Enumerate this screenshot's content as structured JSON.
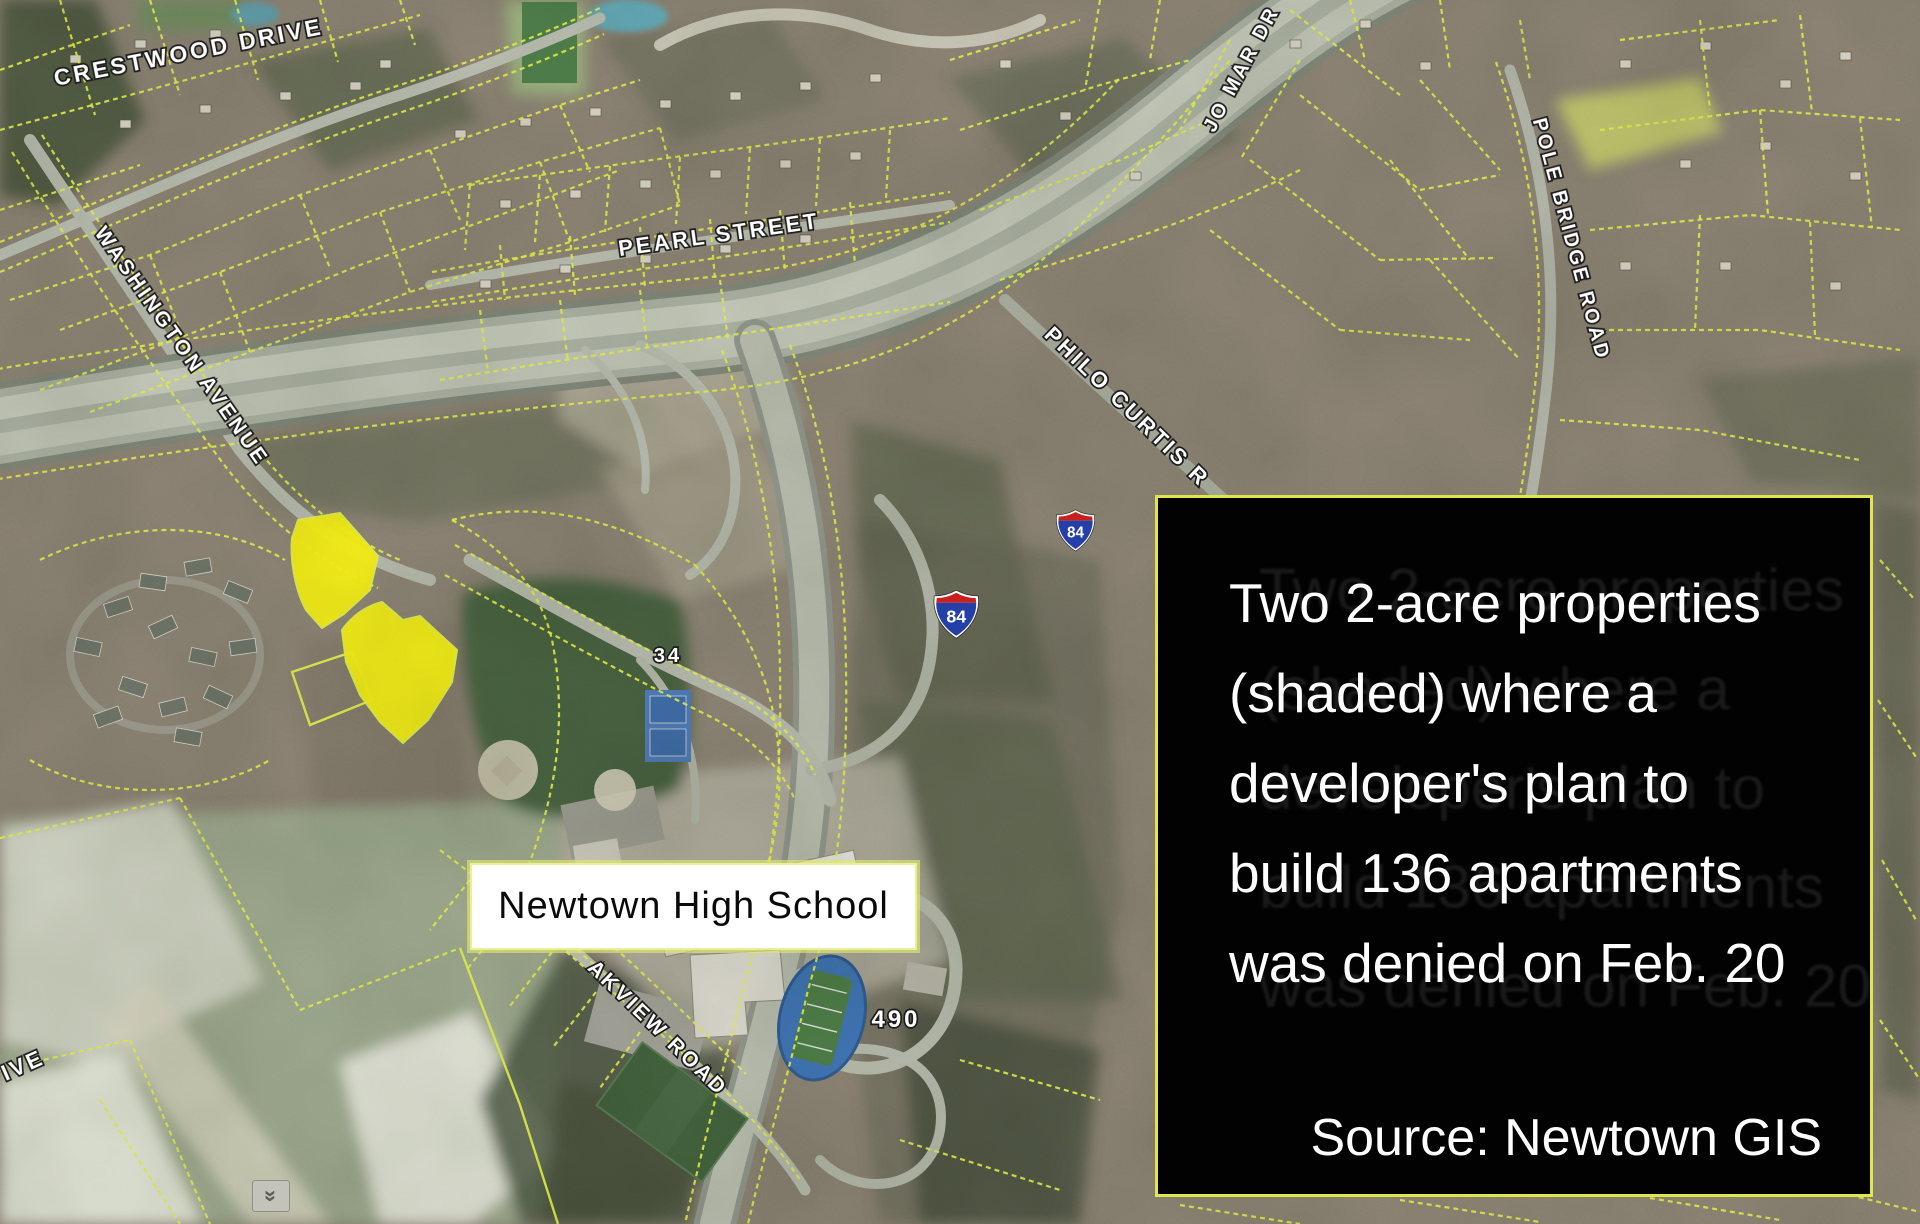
{
  "map": {
    "street_labels": [
      {
        "id": "crestwood",
        "text": "CRESTWOOD DRIVE"
      },
      {
        "id": "washington",
        "text": "WASHINGTON AVENUE"
      },
      {
        "id": "pearl",
        "text": "PEARL STREET"
      },
      {
        "id": "jomar",
        "text": "JO MAR DR"
      },
      {
        "id": "philo",
        "text": "PHILO CURTIS R"
      },
      {
        "id": "polebridge",
        "text": "POLE BRIDGE ROAD"
      },
      {
        "id": "oakview",
        "text": "AKVIEW ROAD"
      },
      {
        "id": "ive",
        "text": "IVE"
      }
    ],
    "route_shields": [
      {
        "number": "84"
      },
      {
        "number": "84"
      }
    ],
    "road_numbers": [
      {
        "text": "34"
      },
      {
        "text": "490"
      }
    ]
  },
  "school_label": {
    "text": "Newtown High School"
  },
  "caption": {
    "lines": [
      "Two 2-acre properties",
      "(shaded) where a",
      "developer's plan to",
      "build 136 apartments",
      "was denied on Feb. 20"
    ],
    "source": "Source: Newtown GIS"
  },
  "icons": {
    "scroll_chevron": "»"
  },
  "colors": {
    "terrain_base": "#8b8273",
    "parcel_line": "#e3ef4a",
    "shaded_parcel": "#f5ee15",
    "caption_bg": "#020202",
    "caption_border": "#dfe54d",
    "caption_text": "#ffffff",
    "school_label_bg": "#ffffff",
    "school_label_text": "#0a0a0a",
    "street_label_text": "#ffffff",
    "street_label_halo": "#1c1c1c",
    "shield_blue": "#2440a8",
    "shield_red": "#c8201c"
  }
}
